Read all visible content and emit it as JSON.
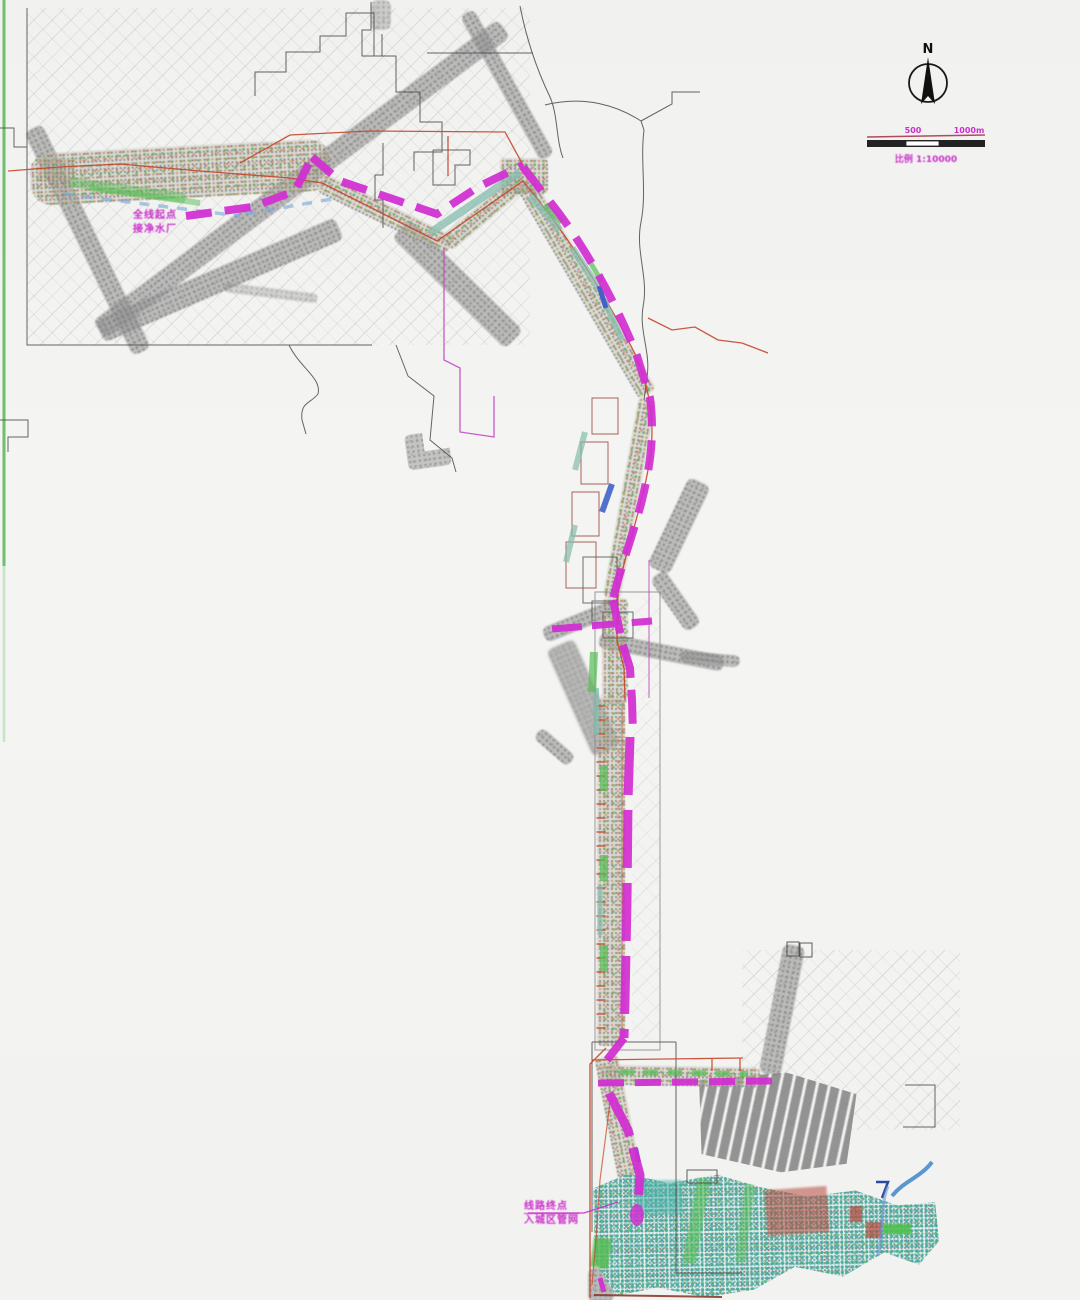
{
  "map": {
    "compass": {
      "label": "N"
    },
    "scale_bar": {
      "tick_mid": "500",
      "tick_end": "1000m",
      "caption": "比例 1:10000"
    },
    "labels": {
      "start_line1": "全线起点",
      "start_line2": "接净水厂",
      "end_line1": "线路终点",
      "end_line2": "入城区管网"
    },
    "colors": {
      "route_magenta": "#d22ed2",
      "existing_line_red": "#c4472b",
      "road_gray": "#979797",
      "water_blue": "#3f63c9",
      "vegetation_green": "#56bd56",
      "survey_teal": "#40aaa2",
      "boundary_black": "#4a4a4a",
      "frame_green": "#6fbf6f"
    }
  }
}
